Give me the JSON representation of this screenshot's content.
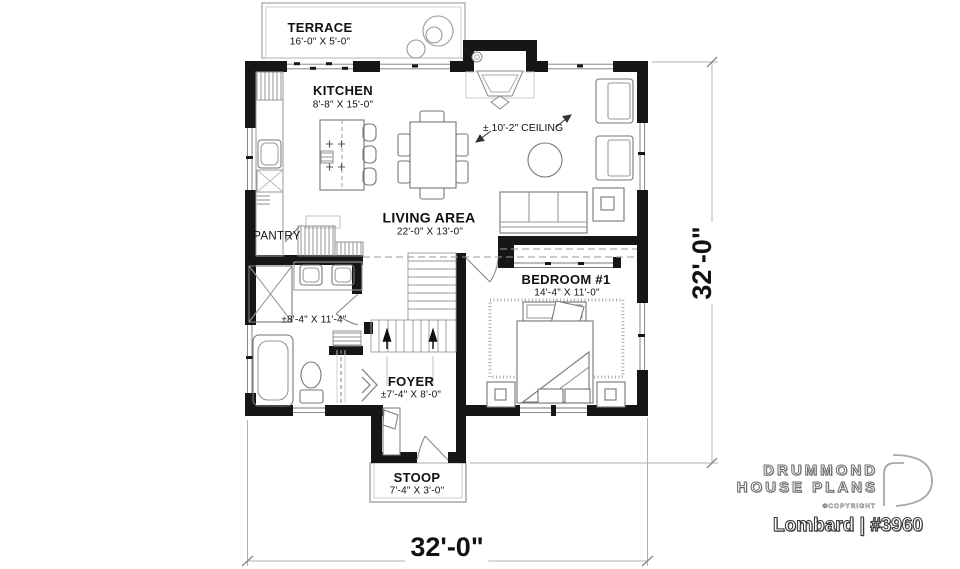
{
  "plan": {
    "rooms": {
      "terrace": {
        "name": "TERRACE",
        "dims": "16'-0\" X 5'-0\""
      },
      "kitchen": {
        "name": "KITCHEN",
        "dims": "8'-8\" X 15'-0\""
      },
      "living": {
        "name": "LIVING AREA",
        "dims": "22'-0\" X 13'-0\""
      },
      "bedroom": {
        "name": "BEDROOM #1",
        "dims": "14'-4\" X 11'-0\""
      },
      "foyer": {
        "name": "FOYER",
        "dims": "±7'-4\" X 8'-0\""
      },
      "stoop": {
        "name": "STOOP",
        "dims": "7'-4\" X 3'-0\""
      },
      "pantry": {
        "name": "PANTRY"
      },
      "bathroom": {
        "dims": "±8'-4\" X 11'-4\""
      }
    },
    "annotations": {
      "ceiling": "± 10'-2\" CEILING"
    },
    "dimensions": {
      "overall_width": "32'-0\"",
      "overall_depth": "32'-0\""
    },
    "colors": {
      "ink": "#161616",
      "furniture_line": "#777777",
      "dim_line": "#b0b0b0"
    }
  },
  "branding": {
    "brand_line1": "DRUMMOND",
    "brand_line2": "HOUSE PLANS",
    "copyright": "©COPYRIGHT",
    "plan_name": "Lombard | #3960"
  }
}
